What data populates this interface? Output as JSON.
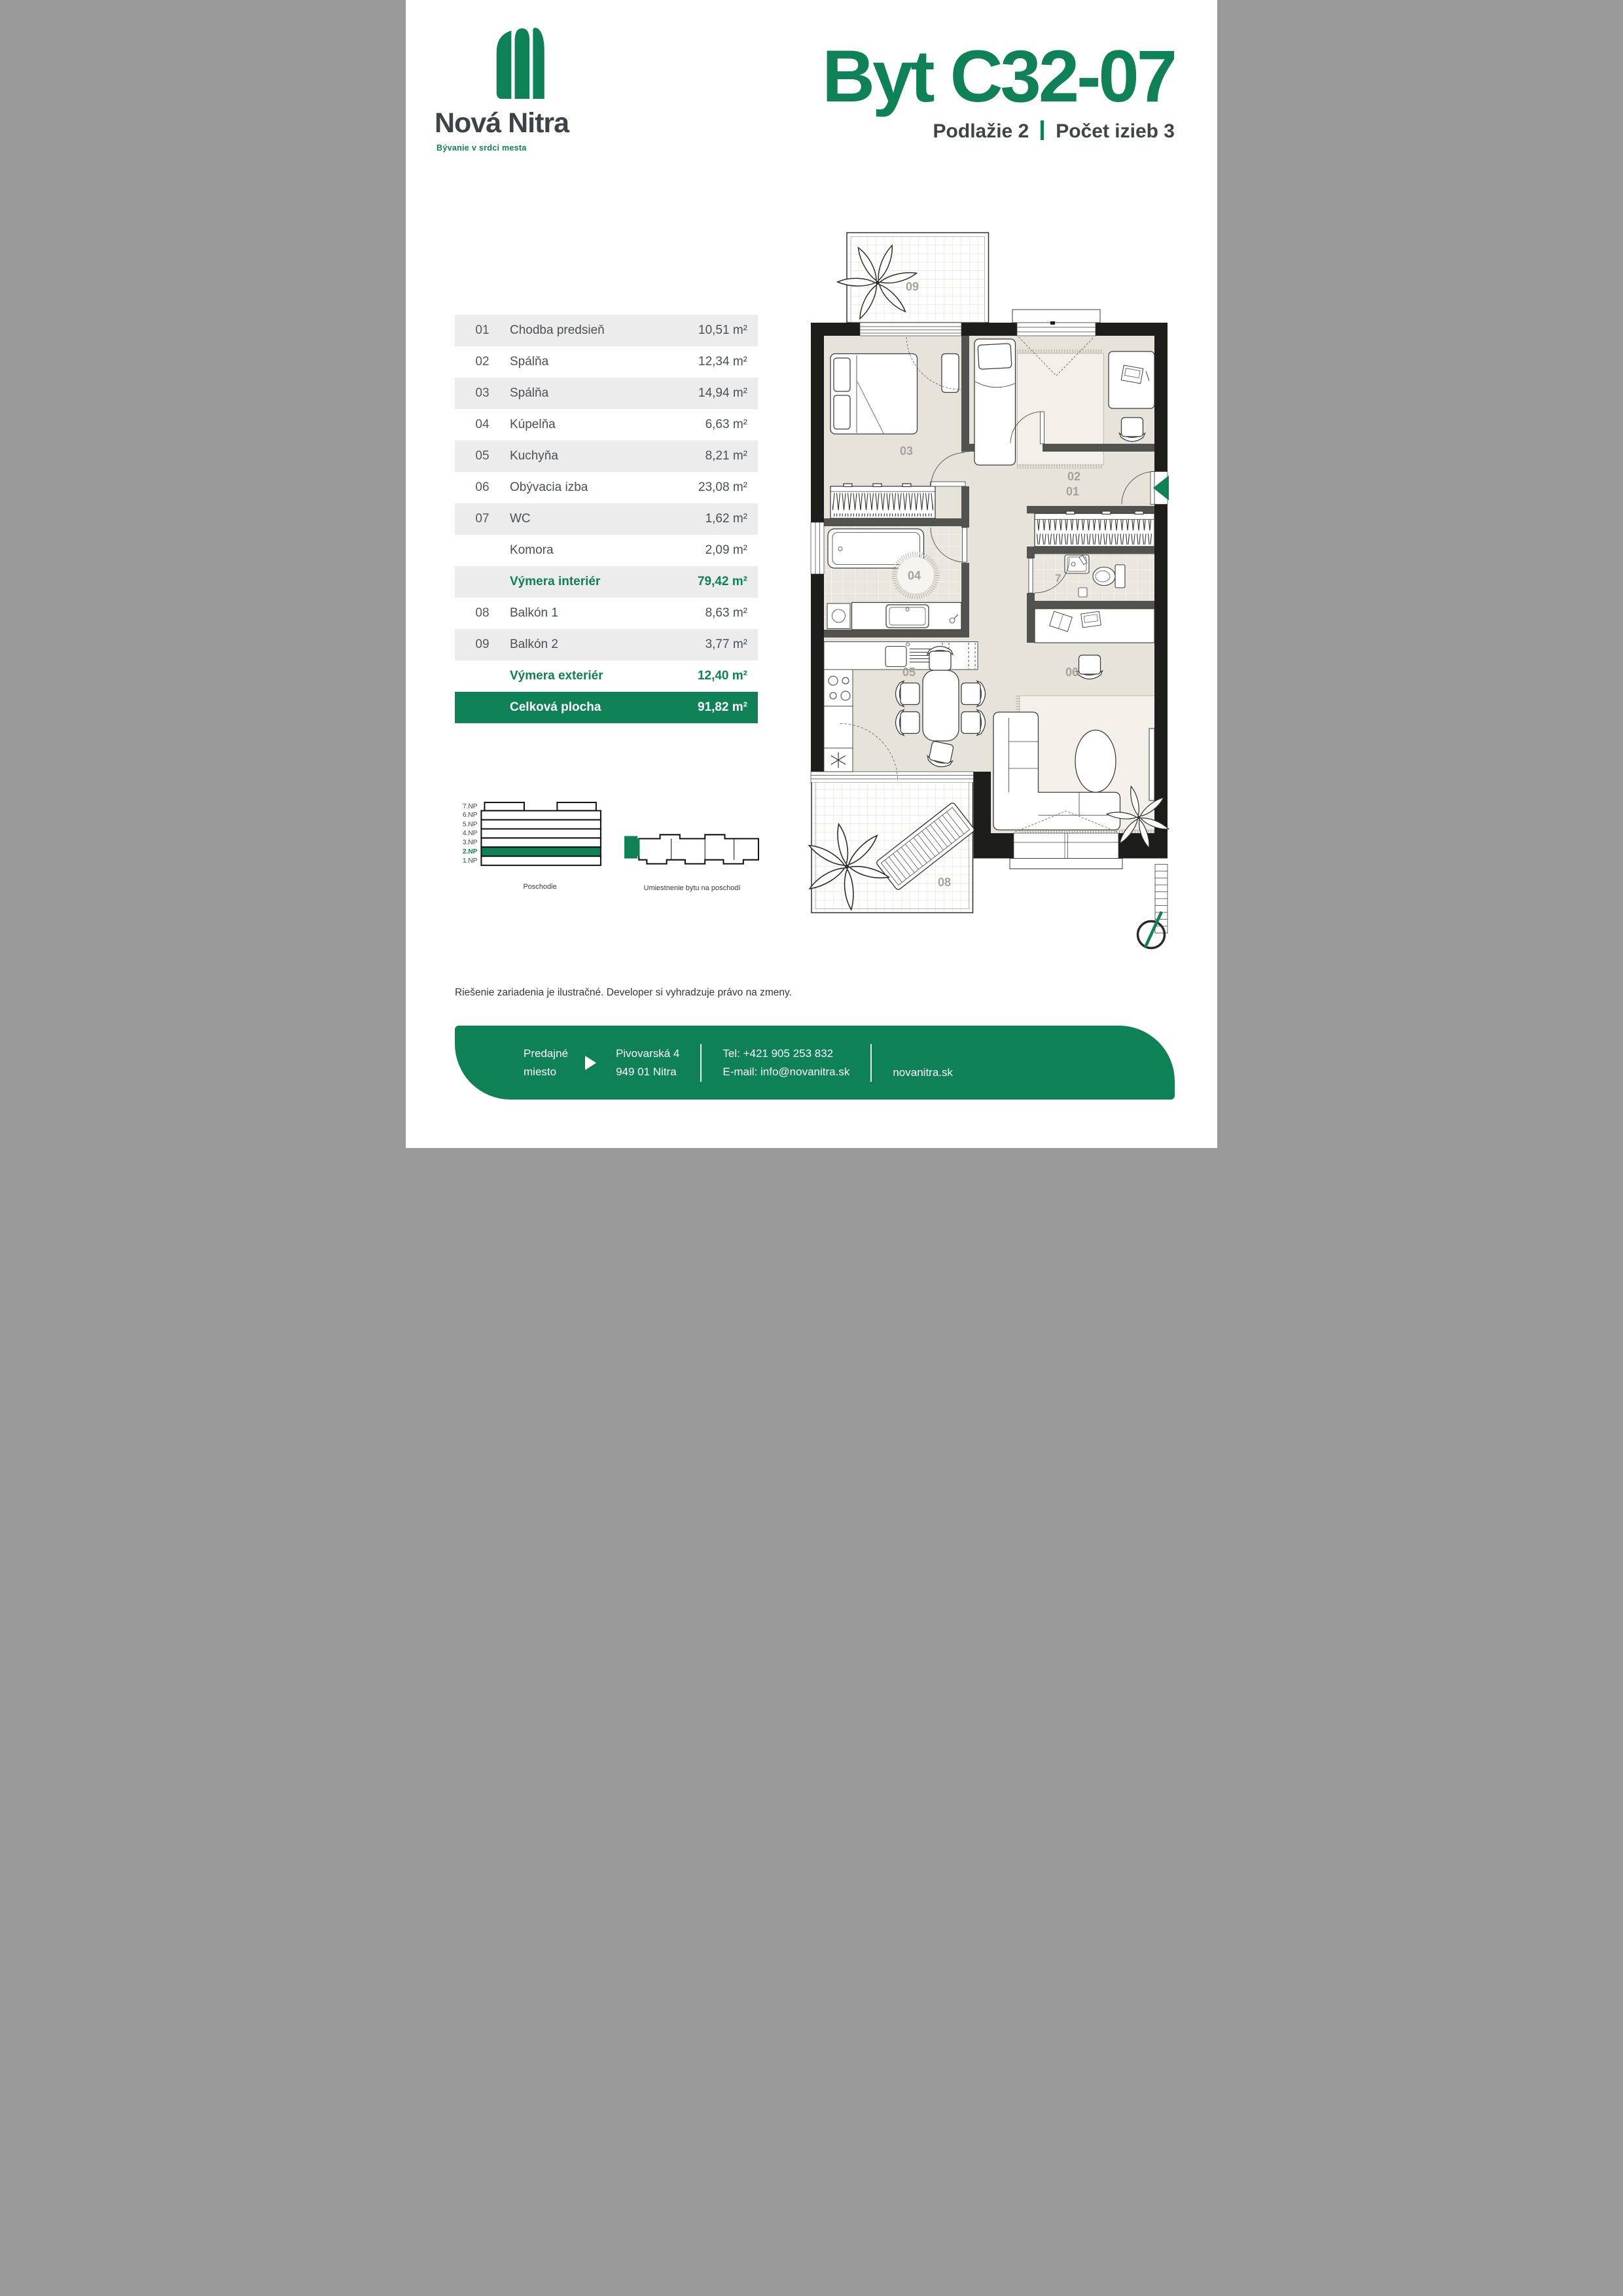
{
  "brand": {
    "name": "Nová Nitra",
    "tagline": "Bývanie v srdci mesta"
  },
  "header": {
    "title": "Byt C32-07",
    "floor_label": "Podlažie 2",
    "rooms_label": "Počet izieb 3"
  },
  "table": {
    "rows": [
      {
        "num": "01",
        "name": "Chodba predsieň",
        "area": "10,51 m²"
      },
      {
        "num": "02",
        "name": "Spálňa",
        "area": "12,34 m²"
      },
      {
        "num": "03",
        "name": "Spálňa",
        "area": "14,94 m²"
      },
      {
        "num": "04",
        "name": "Kúpelňa",
        "area": "6,63 m²"
      },
      {
        "num": "05",
        "name": "Kuchyňa",
        "area": "8,21 m²"
      },
      {
        "num": "06",
        "name": "Obývacia izba",
        "area": "23,08 m²"
      },
      {
        "num": "07",
        "name": "WC",
        "area": "1,62 m²"
      },
      {
        "num": "",
        "name": "Komora",
        "area": "2,09 m²"
      },
      {
        "num": "",
        "name": "Výmera interiér",
        "area": "79,42 m²"
      },
      {
        "num": "08",
        "name": "Balkón 1",
        "area": "8,63 m²"
      },
      {
        "num": "09",
        "name": "Balkón 2",
        "area": "3,77 m²"
      },
      {
        "num": "",
        "name": "Výmera exteriér",
        "area": "12,40 m²"
      },
      {
        "num": "",
        "name": "Celková plocha",
        "area": "91,82 m²"
      }
    ]
  },
  "plan": {
    "labels": {
      "r01": "01",
      "r02": "02",
      "r03": "03",
      "r04": "04",
      "r05": "05",
      "r06": "06",
      "r07": "7",
      "r08": "08",
      "r09": "09"
    }
  },
  "floors": {
    "items": [
      "7.NP",
      "6.NP",
      "5.NP",
      "4.NP",
      "3.NP",
      "2.NP",
      "1.NP"
    ],
    "caption": "Poschodie"
  },
  "location": {
    "caption": "Umiestnenie bytu na poschodí"
  },
  "disclaimer": "Riešenie zariadenia je ilustračné. Developer si vyhradzuje právo na zmeny.",
  "footer": {
    "sales_line1": "Predajné",
    "sales_line2": "miesto",
    "address_line1": "Pivovarská 4",
    "address_line2": "949 01 Nitra",
    "phone": "Tel: +421 905 253 832",
    "email": "E-mail: info@novanitra.sk",
    "website": "novanitra.sk"
  },
  "colors": {
    "green": "#0f8156",
    "dark_text": "#3e4347",
    "row_gray": "#ececec"
  }
}
